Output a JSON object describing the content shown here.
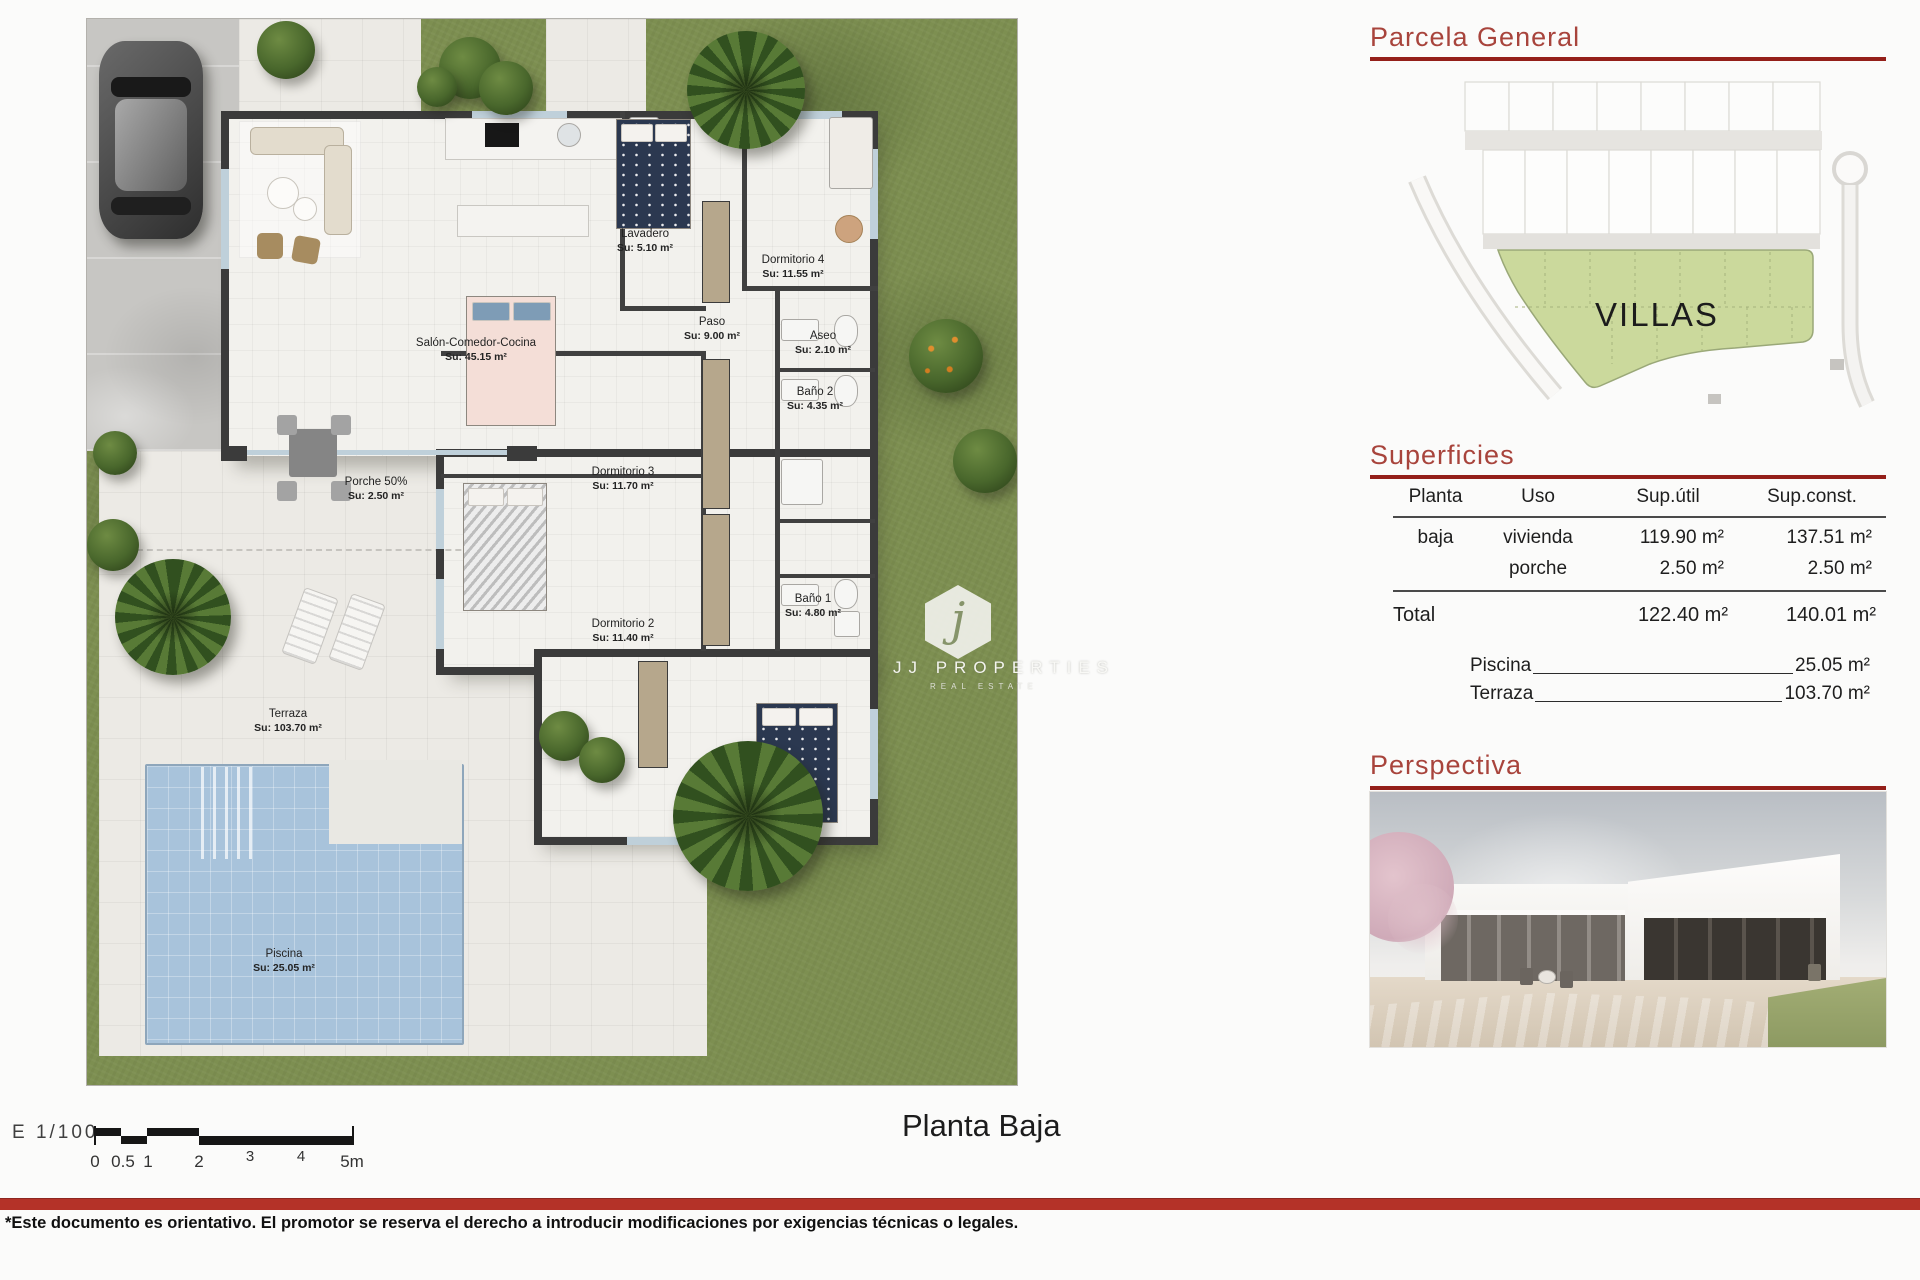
{
  "document": {
    "plan_title": "Planta  Baja",
    "scale_label": "E  1/100",
    "scale_ticks": [
      "0",
      "0.5",
      "1",
      "2",
      "3",
      "4",
      "5m"
    ],
    "disclaimer": "*Este documento es orientativo. El promotor se reserva el derecho a introducir modificaciones por exigencias técnicas o legales."
  },
  "colors": {
    "accent_red_band": "#b43228",
    "heading_red": "#a8443c",
    "rule_dark_red": "#941f19",
    "grass_green": "#7d8f51",
    "villas_zone_green": "#cbd99c",
    "pool_blue": "#a8c3db",
    "wall_dark": "#3b3b3b"
  },
  "floor_plan": {
    "rooms": [
      {
        "name": "Salón-Comedor-Cocina",
        "area": "Su: 45.15 m²"
      },
      {
        "name": "Lavadero",
        "area": "Su: 5.10 m²"
      },
      {
        "name": "Dormitorio 4",
        "area": "Su: 11.55 m²"
      },
      {
        "name": "Paso",
        "area": "Su: 9.00 m²"
      },
      {
        "name": "Aseo",
        "area": "Su: 2.10 m²"
      },
      {
        "name": "Baño 2",
        "area": "Su: 4.35 m²"
      },
      {
        "name": "Dormitorio 3",
        "area": "Su: 11.70 m²"
      },
      {
        "name": "Porche 50%",
        "area": "Su: 2.50 m²"
      },
      {
        "name": "Dormitorio 2",
        "area": "Su: 11.40 m²"
      },
      {
        "name": "Baño 1",
        "area": "Su: 4.80 m²"
      },
      {
        "name": "Terraza",
        "area": "Su: 103.70 m²"
      },
      {
        "name": "Dormitorio 1",
        "area": "Su: 14.75 m²"
      },
      {
        "name": "Piscina",
        "area": "Su: 25.05 m²"
      }
    ],
    "watermark": {
      "initial": "j",
      "brand": "JJ PROPERTIES",
      "sub": "REAL ESTATE"
    }
  },
  "parcela": {
    "heading": "Parcela  General",
    "zone_label": "VILLAS"
  },
  "superficies": {
    "heading": "Superficies",
    "columns": [
      "Planta",
      "Uso",
      "Sup.útil",
      "Sup.const."
    ],
    "rows": [
      {
        "planta": "baja",
        "uso": "vivienda",
        "util": "119.90  m²",
        "const": "137.51  m²"
      },
      {
        "planta": "",
        "uso": "porche",
        "util": "2.50  m²",
        "const": "2.50  m²"
      }
    ],
    "total": {
      "label": "Total",
      "util": "122.40  m²",
      "const": "140.01  m²"
    },
    "extras": [
      {
        "label": "Piscina",
        "value": "25.05  m²"
      },
      {
        "label": "Terraza",
        "value": "103.70  m²"
      }
    ]
  },
  "perspectiva": {
    "heading": "Perspectiva"
  }
}
